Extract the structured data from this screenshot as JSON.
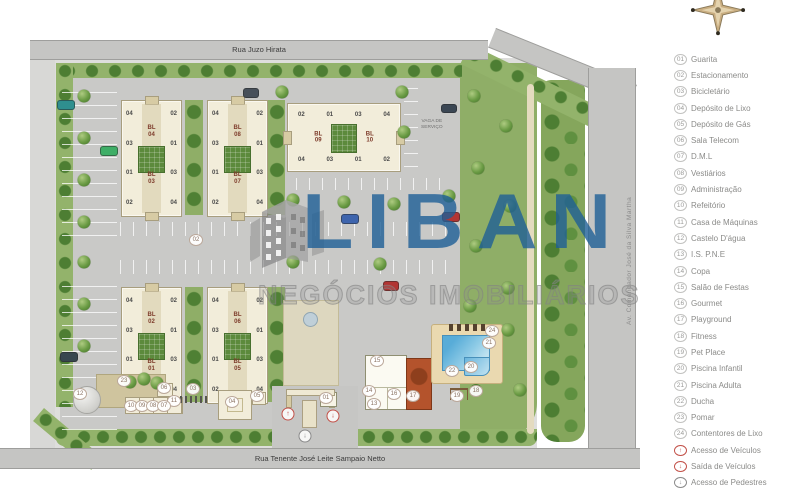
{
  "roads": {
    "top": "Rua Juzo Hirata",
    "bottom": "Rua Tenente José Leite Sampaio Netto",
    "right": "Av. Comendador José da Silva Martha"
  },
  "watermark": {
    "brand": "LIBAN",
    "tagline": "NEGÓCIOS IMOBILIÁRIOS",
    "brand_color": "#1e5f96"
  },
  "legend": {
    "items": [
      {
        "num": "01",
        "label": "Guarita"
      },
      {
        "num": "02",
        "label": "Estacionamento"
      },
      {
        "num": "03",
        "label": "Bicicletário"
      },
      {
        "num": "04",
        "label": "Depósito de Lixo"
      },
      {
        "num": "05",
        "label": "Depósito de Gás"
      },
      {
        "num": "06",
        "label": "Sala Telecom"
      },
      {
        "num": "07",
        "label": "D.M.L"
      },
      {
        "num": "08",
        "label": "Vestiários"
      },
      {
        "num": "09",
        "label": "Administração"
      },
      {
        "num": "10",
        "label": "Refeitório"
      },
      {
        "num": "11",
        "label": "Casa de Máquinas"
      },
      {
        "num": "12",
        "label": "Castelo D'água"
      },
      {
        "num": "13",
        "label": "I.S. P.N.E"
      },
      {
        "num": "14",
        "label": "Copa"
      },
      {
        "num": "15",
        "label": "Salão de Festas"
      },
      {
        "num": "16",
        "label": "Gourmet"
      },
      {
        "num": "17",
        "label": "Playground"
      },
      {
        "num": "18",
        "label": "Fitness"
      },
      {
        "num": "19",
        "label": "Pet Place"
      },
      {
        "num": "20",
        "label": "Piscina Infantil"
      },
      {
        "num": "21",
        "label": "Piscina Adulta"
      },
      {
        "num": "22",
        "label": "Ducha"
      },
      {
        "num": "23",
        "label": "Pomar"
      },
      {
        "num": "24",
        "label": "Contentores de Lixo"
      },
      {
        "num": "↑",
        "label": "Acesso de Veículos",
        "color": "#c25048"
      },
      {
        "num": "↓",
        "label": "Saída de Veículos",
        "color": "#c25048"
      },
      {
        "num": "↓",
        "label": "Acesso de Pedestres",
        "color": "#8a8a8a"
      }
    ]
  },
  "plan": {
    "service_parking_label": "VAGA DE\nSERVIÇO",
    "vertical_slabs": [
      {
        "bl_top": "BL\n04",
        "bl_bottom": "BL\n03",
        "left_units": [
          "04",
          "03",
          "01",
          "02"
        ],
        "right_units": [
          "02",
          "01",
          "03",
          "04"
        ]
      },
      {
        "bl_top": "BL\n08",
        "bl_bottom": "BL\n07",
        "left_units": [
          "04",
          "03",
          "01",
          "02"
        ],
        "right_units": [
          "02",
          "01",
          "03",
          "04"
        ]
      },
      {
        "bl_top": "BL\n02",
        "bl_bottom": "BL\n01",
        "left_units": [
          "04",
          "03",
          "01",
          "02"
        ],
        "right_units": [
          "02",
          "01",
          "03",
          "04"
        ]
      },
      {
        "bl_top": "BL\n06",
        "bl_bottom": "BL\n05",
        "left_units": [
          "04",
          "03",
          "01",
          "02"
        ],
        "right_units": [
          "02",
          "01",
          "03",
          "04"
        ]
      }
    ],
    "horizontal_slab": {
      "bl_left": "BL\n09",
      "bl_right": "BL\n10",
      "top_units": [
        "02",
        "01",
        "03",
        "04"
      ],
      "bottom_units": [
        "04",
        "03",
        "01",
        "02"
      ]
    },
    "markers": [
      {
        "num": "21",
        "x": 489,
        "y": 343
      },
      {
        "num": "20",
        "x": 471,
        "y": 367
      },
      {
        "num": "22",
        "x": 452,
        "y": 371
      },
      {
        "num": "19",
        "x": 457,
        "y": 396
      },
      {
        "num": "18",
        "x": 476,
        "y": 391
      },
      {
        "num": "17",
        "x": 413,
        "y": 396
      },
      {
        "num": "16",
        "x": 394,
        "y": 394
      },
      {
        "num": "15",
        "x": 377,
        "y": 361
      },
      {
        "num": "14",
        "x": 369,
        "y": 391
      },
      {
        "num": "13",
        "x": 374,
        "y": 404
      },
      {
        "num": "24",
        "x": 492,
        "y": 331
      },
      {
        "num": "12",
        "x": 80,
        "y": 394
      },
      {
        "num": "23",
        "x": 124,
        "y": 381
      },
      {
        "num": "11",
        "x": 174,
        "y": 401
      },
      {
        "num": "10",
        "x": 131,
        "y": 406
      },
      {
        "num": "09",
        "x": 142,
        "y": 406
      },
      {
        "num": "08",
        "x": 153,
        "y": 406
      },
      {
        "num": "07",
        "x": 164,
        "y": 406
      },
      {
        "num": "06",
        "x": 164,
        "y": 388
      },
      {
        "num": "05",
        "x": 257,
        "y": 396
      },
      {
        "num": "04",
        "x": 232,
        "y": 402
      },
      {
        "num": "03",
        "x": 193,
        "y": 389
      },
      {
        "num": "02",
        "x": 196,
        "y": 240
      },
      {
        "num": "01",
        "x": 326,
        "y": 398
      }
    ],
    "arrows": [
      {
        "sym": "↑",
        "x": 288,
        "y": 414,
        "color": "#c25048"
      },
      {
        "sym": "↓",
        "x": 333,
        "y": 416,
        "color": "#c25048"
      },
      {
        "sym": "↓",
        "x": 305,
        "y": 436,
        "color": "#8a8a8a"
      }
    ],
    "trees": [
      {
        "x": 84,
        "y": 96
      },
      {
        "x": 84,
        "y": 138
      },
      {
        "x": 84,
        "y": 180
      },
      {
        "x": 84,
        "y": 222
      },
      {
        "x": 84,
        "y": 262
      },
      {
        "x": 84,
        "y": 304
      },
      {
        "x": 84,
        "y": 346
      },
      {
        "x": 293,
        "y": 200
      },
      {
        "x": 344,
        "y": 202
      },
      {
        "x": 394,
        "y": 204
      },
      {
        "x": 449,
        "y": 196
      },
      {
        "x": 293,
        "y": 262
      },
      {
        "x": 380,
        "y": 264
      },
      {
        "x": 474,
        "y": 96
      },
      {
        "x": 506,
        "y": 126
      },
      {
        "x": 478,
        "y": 168
      },
      {
        "x": 510,
        "y": 206
      },
      {
        "x": 476,
        "y": 246
      },
      {
        "x": 508,
        "y": 288
      },
      {
        "x": 470,
        "y": 306
      },
      {
        "x": 282,
        "y": 92
      },
      {
        "x": 402,
        "y": 92
      },
      {
        "x": 404,
        "y": 132
      },
      {
        "x": 130,
        "y": 382
      },
      {
        "x": 144,
        "y": 379
      },
      {
        "x": 157,
        "y": 383
      },
      {
        "x": 508,
        "y": 330
      },
      {
        "x": 520,
        "y": 390
      }
    ],
    "cars": [
      {
        "x": 57,
        "y": 100,
        "w": 16,
        "h": 8,
        "color": "#2f8f8f"
      },
      {
        "x": 100,
        "y": 146,
        "w": 16,
        "h": 8,
        "color": "#3fae67"
      },
      {
        "x": 243,
        "y": 88,
        "w": 14,
        "h": 8,
        "color": "#47505a"
      },
      {
        "x": 441,
        "y": 104,
        "w": 14,
        "h": 7,
        "color": "#3b4754"
      },
      {
        "x": 341,
        "y": 214,
        "w": 16,
        "h": 8,
        "color": "#3d64ad"
      },
      {
        "x": 442,
        "y": 212,
        "w": 16,
        "h": 8,
        "color": "#b23533"
      },
      {
        "x": 383,
        "y": 281,
        "w": 14,
        "h": 8,
        "color": "#b23533"
      },
      {
        "x": 60,
        "y": 352,
        "w": 16,
        "h": 8,
        "color": "#37474f"
      }
    ]
  }
}
